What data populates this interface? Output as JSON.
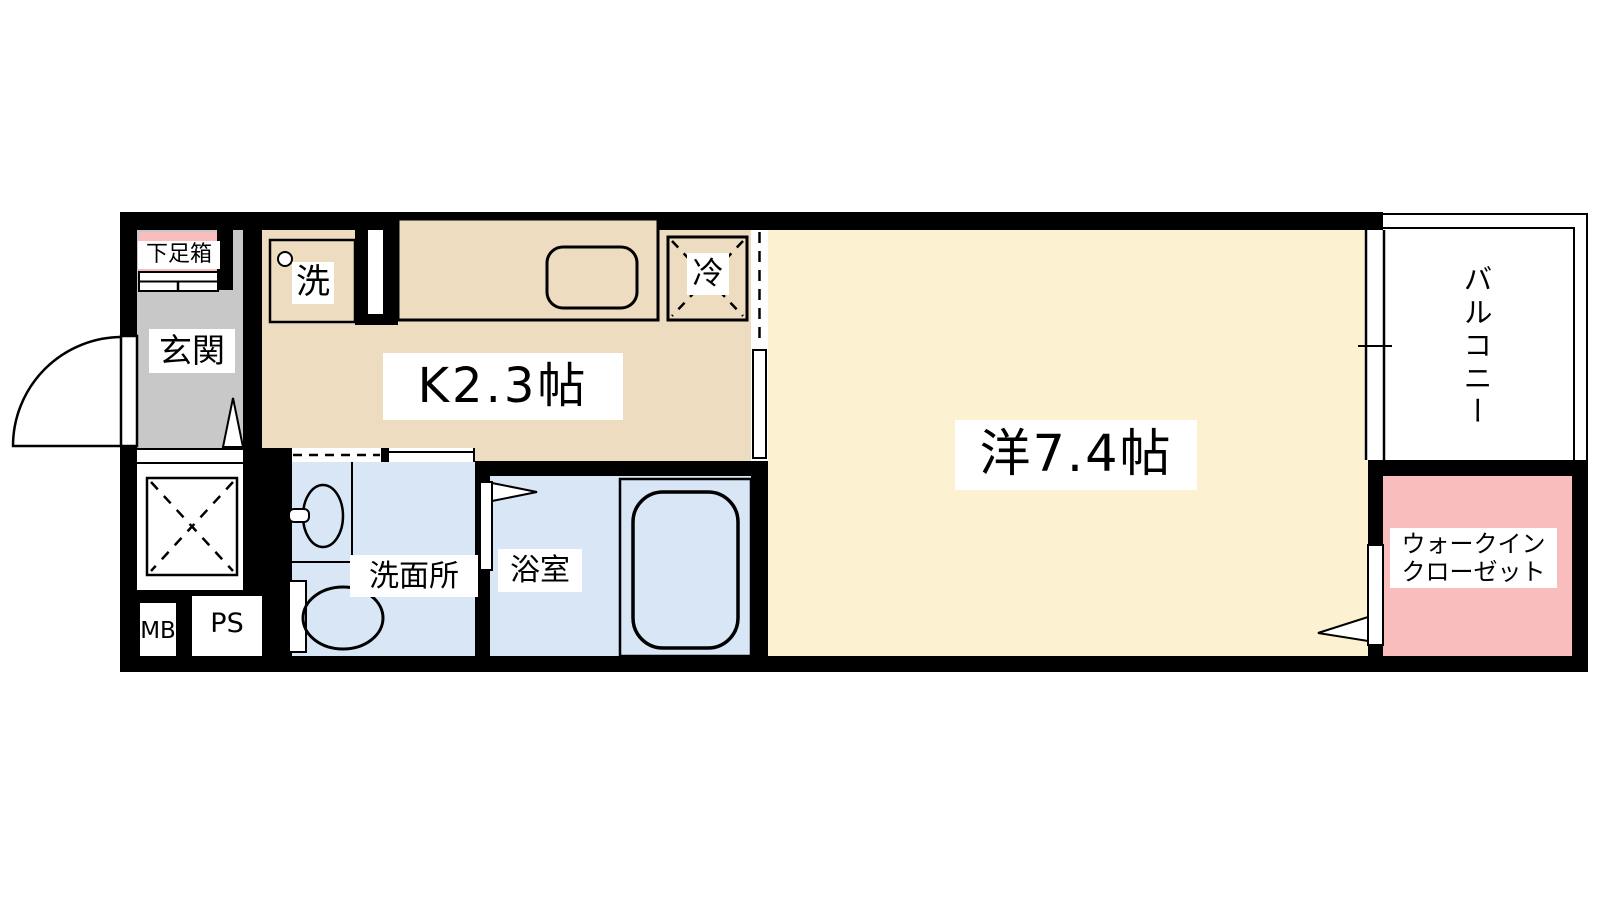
{
  "plan": {
    "type": "apartment-floor-plan",
    "rooms": {
      "entrance": {
        "label": "玄関"
      },
      "shoe_box": {
        "label": "下足箱"
      },
      "kitchen": {
        "label": "K2.3帖"
      },
      "washing_machine": {
        "label": "洗"
      },
      "refrigerator": {
        "label": "冷"
      },
      "western_room": {
        "label": "洋7.4帖"
      },
      "balcony": {
        "label": "バルコニー"
      },
      "walk_in_closet": {
        "label_line1": "ウォークイン",
        "label_line2": "クローゼット"
      },
      "washroom": {
        "label": "洗面所"
      },
      "bathroom": {
        "label": "浴室"
      },
      "meter_box": {
        "label": "MB"
      },
      "pipe_space": {
        "label": "PS"
      }
    },
    "colors": {
      "wall": "#000000",
      "background": "#FFFFFF",
      "entrance_floor": "#C8C8C8",
      "kitchen_floor": "#EDDCC0",
      "western_room_floor": "#FCF1D0",
      "wet_area_floor": "#D9E6F6",
      "closet_floor": "#FABDBD",
      "shoe_box_fill": "#FABDBD"
    }
  }
}
